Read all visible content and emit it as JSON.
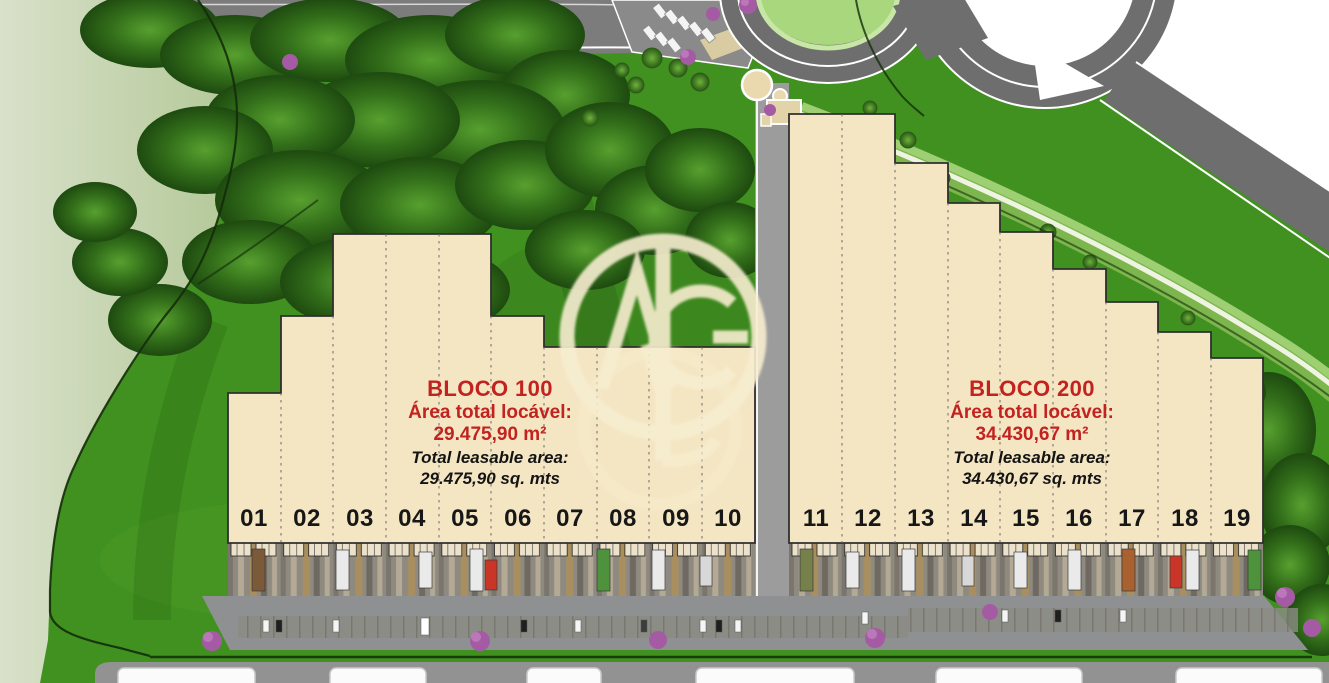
{
  "blocks": [
    {
      "id": "bloco-100",
      "name": "BLOCO 100",
      "area_label_pt": "Área total locável:",
      "area_value_pt": "29.475,90 m²",
      "area_label_en": "Total leasable area:",
      "area_value_en": "29.475,90 sq. mts",
      "units": [
        "01",
        "02",
        "03",
        "04",
        "05",
        "06",
        "07",
        "08",
        "09",
        "10"
      ]
    },
    {
      "id": "bloco-200",
      "name": "BLOCO 200",
      "area_label_pt": "Área total locável:",
      "area_value_pt": "34.430,67 m²",
      "area_label_en": "Total leasable area:",
      "area_value_en": "34.430,67 sq. mts",
      "units": [
        "11",
        "12",
        "13",
        "14",
        "15",
        "16",
        "17",
        "18",
        "19"
      ]
    }
  ],
  "watermark": {
    "monogram": "NL"
  },
  "colors": {
    "accent_red": "#c32320",
    "building_beige": "#f4e6c3",
    "grass_green": "#419120",
    "pale_green": "#b9cd9f",
    "road_gray": "#6e6e6e",
    "apron_gray": "#8f9092",
    "label_black": "#171717",
    "watermark_cream": "#f7edd0",
    "flower_tree_purple": "#a55ba3"
  }
}
